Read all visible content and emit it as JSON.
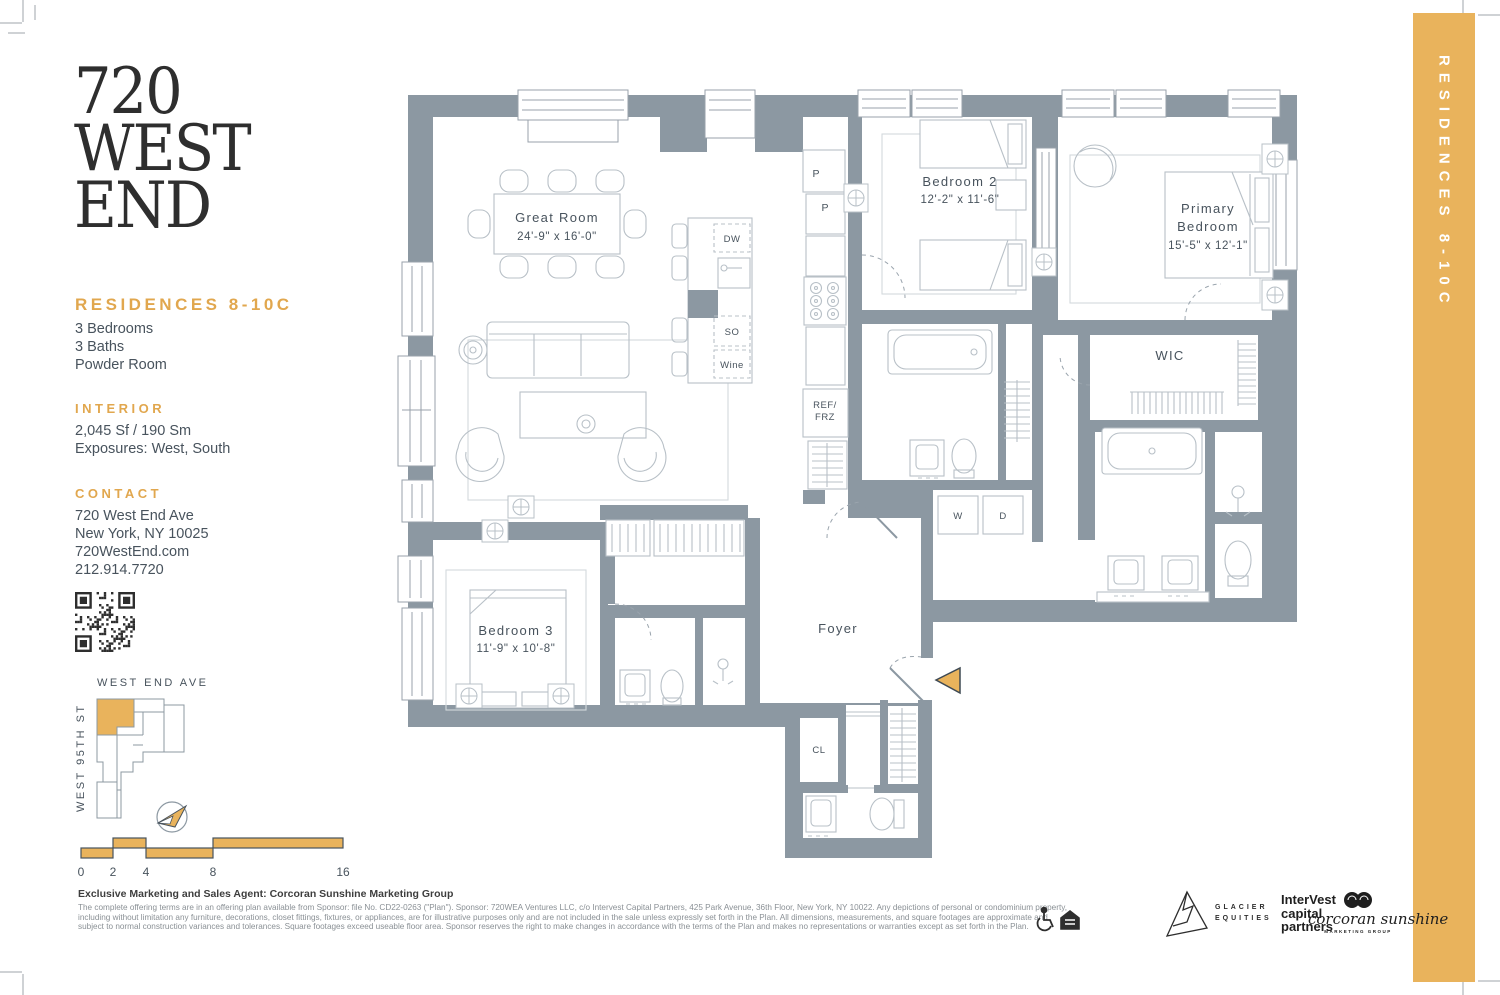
{
  "colors": {
    "gold": "#E9B35C",
    "gold_heading": "#E1A74E",
    "wall_gray": "#8C98A2",
    "furniture_line": "#B8C0C7",
    "ink": "#48535D"
  },
  "brand": {
    "logo_lines": [
      "720",
      "WEST",
      "END"
    ]
  },
  "listing": {
    "title": "RESIDENCES 8-10C",
    "features": [
      "3 Bedrooms",
      "3 Baths",
      "Powder Room"
    ],
    "interior": {
      "heading": "INTERIOR",
      "area": "2,045 Sf / 190 Sm",
      "exposures": "Exposures: West, South"
    },
    "contact": {
      "heading": "CONTACT",
      "lines": [
        "720 West End Ave",
        "New York, NY 10025",
        "720WestEnd.com",
        "212.914.7720"
      ]
    }
  },
  "key_plan": {
    "street_top": "WEST END AVE",
    "street_left": "WEST 95TH ST"
  },
  "scale_bar": {
    "labels": [
      "0",
      "2",
      "4",
      "8",
      "16"
    ]
  },
  "floor_plan": {
    "great_room": {
      "name": "Great Room",
      "dims": "24'-9\" x 16'-0\""
    },
    "bedroom_2": {
      "name": "Bedroom 2",
      "dims": "12'-2\" x 11'-6\""
    },
    "primary_bedroom": {
      "name_line_1": "Primary",
      "name_line_2": "Bedroom",
      "dims": "15'-5\" x 12'-1\""
    },
    "bedroom_3": {
      "name": "Bedroom 3",
      "dims": "11'-9\" x 10'-8\""
    },
    "wic": "WIC",
    "foyer": "Foyer",
    "closet": "CL",
    "appliances": {
      "dishwasher": "DW",
      "speed_oven": "SO",
      "wine": "Wine",
      "fridge_line_1": "REF/",
      "fridge_line_2": "FRZ",
      "washer": "W",
      "dryer": "D",
      "pantry_1": "P",
      "pantry_2": "P"
    }
  },
  "side_band": {
    "label": "RESIDENCES 8-10C"
  },
  "footer": {
    "agent_line": "Exclusive Marketing and Sales Agent: Corcoran Sunshine Marketing Group",
    "disclaimer_lines": [
      "The complete offering terms are in an offering plan available from Sponsor: file No. CD22-0263 (\"Plan\"). Sponsor: 720WEA Ventures LLC, c/o Intervest Capital Partners, 425 Park Avenue, 36th Floor, New York, NY 10022. Any depictions of personal or condominium property,",
      "including without limitation any furniture, decorations, closet fittings, fixtures, or appliances, are for illustrative purposes only and are not included in the sale unless expressly set forth in the Plan.  All dimensions, measurements, and square footages are approximate and",
      "subject to normal construction variances and tolerances. Square footages exceed useable floor area. Sponsor reserves the right to make changes in accordance with the terms of the Plan and makes no representations or warranties except as set forth in the Plan."
    ],
    "partners": {
      "glacier_line_1": "GLACIER",
      "glacier_line_2": "EQUITIES",
      "intervest_lines": [
        "InterVest",
        "capital",
        "partners"
      ],
      "corcoran": "corcoran sunshine",
      "corcoran_sub": "MARKETING GROUP"
    }
  }
}
